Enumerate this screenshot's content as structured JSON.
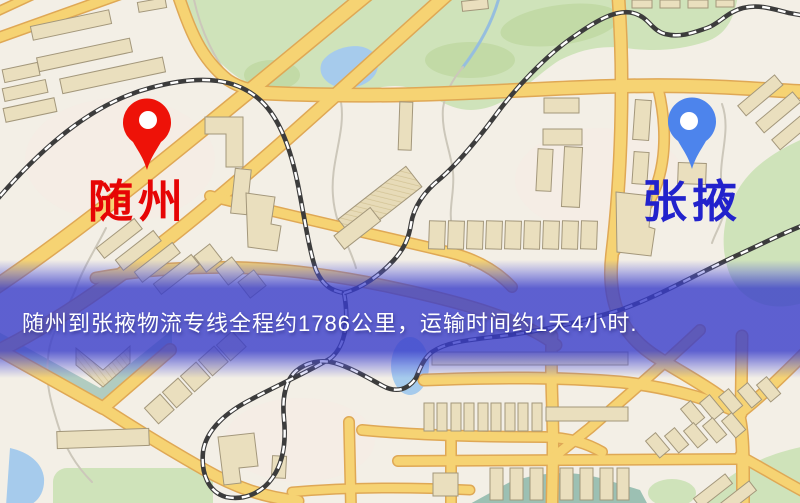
{
  "banner": {
    "text": "随州到张掖物流专线全程约1786公里，运输时间约1天4小时.",
    "distance_km": "1786",
    "transit_time": "1天4小时",
    "text_color": "#ffffff",
    "band_color": "#383cca"
  },
  "markers": {
    "origin": {
      "label": "随州",
      "pin_color": "#ee1208",
      "label_color": "#e60505"
    },
    "destination": {
      "label": "张掖",
      "pin_color": "#4d84ec",
      "label_color": "#2222cc"
    }
  },
  "theme": {
    "map_background": "#f3efe6",
    "road_fill": "#f6d373",
    "road_casing": "#dfa855",
    "railway": "#3c3c3c",
    "building": "#eadfbe",
    "park_green": "#cfe3ba",
    "water_blue": "#a6cbec"
  }
}
